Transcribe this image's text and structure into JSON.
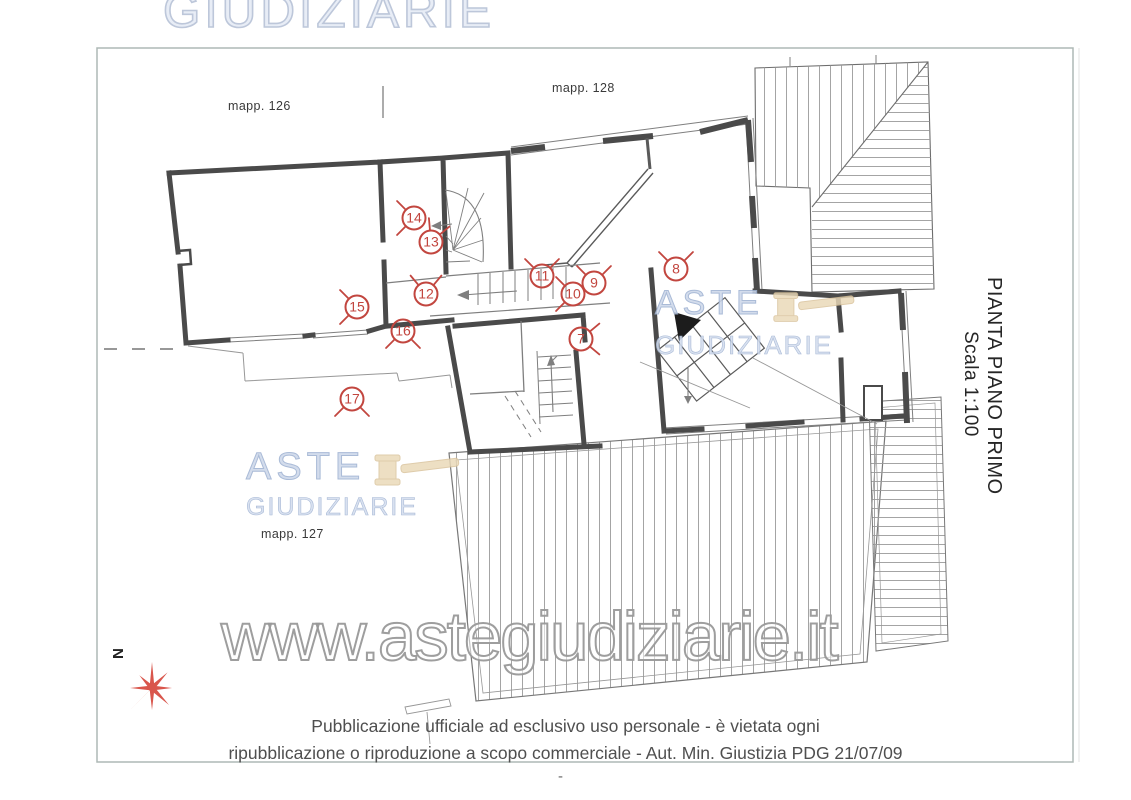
{
  "header": {
    "top_watermark": "GIUDIZIARIE"
  },
  "plan": {
    "title": "PIANTA PIANO PRIMO",
    "scale": "Scala 1:100",
    "north_label": "N",
    "parcels": [
      {
        "label": "mapp. 126"
      },
      {
        "label": "mapp. 128"
      },
      {
        "label": "mapp. 127"
      }
    ],
    "logo_watermark": {
      "line1": "ASTE",
      "line2": "GIUDIZIARIE"
    },
    "markers": [
      {
        "num": "7",
        "x": 581,
        "y": 339,
        "arms": [
          40,
          -40
        ]
      },
      {
        "num": "8",
        "x": 676,
        "y": 269,
        "arms": [
          135,
          45
        ]
      },
      {
        "num": "9",
        "x": 594,
        "y": 283,
        "arms": [
          135,
          45
        ]
      },
      {
        "num": "10",
        "x": 573,
        "y": 294,
        "arms": [
          135,
          225
        ]
      },
      {
        "num": "11",
        "x": 542,
        "y": 276,
        "arms": [
          135,
          45
        ]
      },
      {
        "num": "12",
        "x": 426,
        "y": 294,
        "arms": [
          130,
          50
        ]
      },
      {
        "num": "13",
        "x": 431,
        "y": 242,
        "arms": [
          95,
          40
        ]
      },
      {
        "num": "14",
        "x": 414,
        "y": 218,
        "arms": [
          135,
          225
        ]
      },
      {
        "num": "15",
        "x": 357,
        "y": 307,
        "arms": [
          135,
          225
        ]
      },
      {
        "num": "16",
        "x": 403,
        "y": 331,
        "arms": [
          225,
          315
        ]
      },
      {
        "num": "17",
        "x": 352,
        "y": 399,
        "arms": [
          225,
          315
        ]
      }
    ]
  },
  "footer": {
    "site_watermark": "www.astegiudiziarie.it",
    "disclaimer_line1": "Pubblicazione ufficiale ad esclusivo uso personale - è vietata ogni",
    "disclaimer_line2": "ripubblicazione o riproduzione a scopo commerciale - Aut. Min. Giustizia PDG 21/07/09",
    "page_mark": "-"
  },
  "colors": {
    "marker_red": "#c2463f",
    "north_red": "#d9564c",
    "watermark_blue": "#aebdd8",
    "gavel_tan": "#e9d8b8",
    "wall_dark": "#4a4a4a",
    "line_gray": "#7f7f7f",
    "frame_gray": "#aeb9b5"
  }
}
